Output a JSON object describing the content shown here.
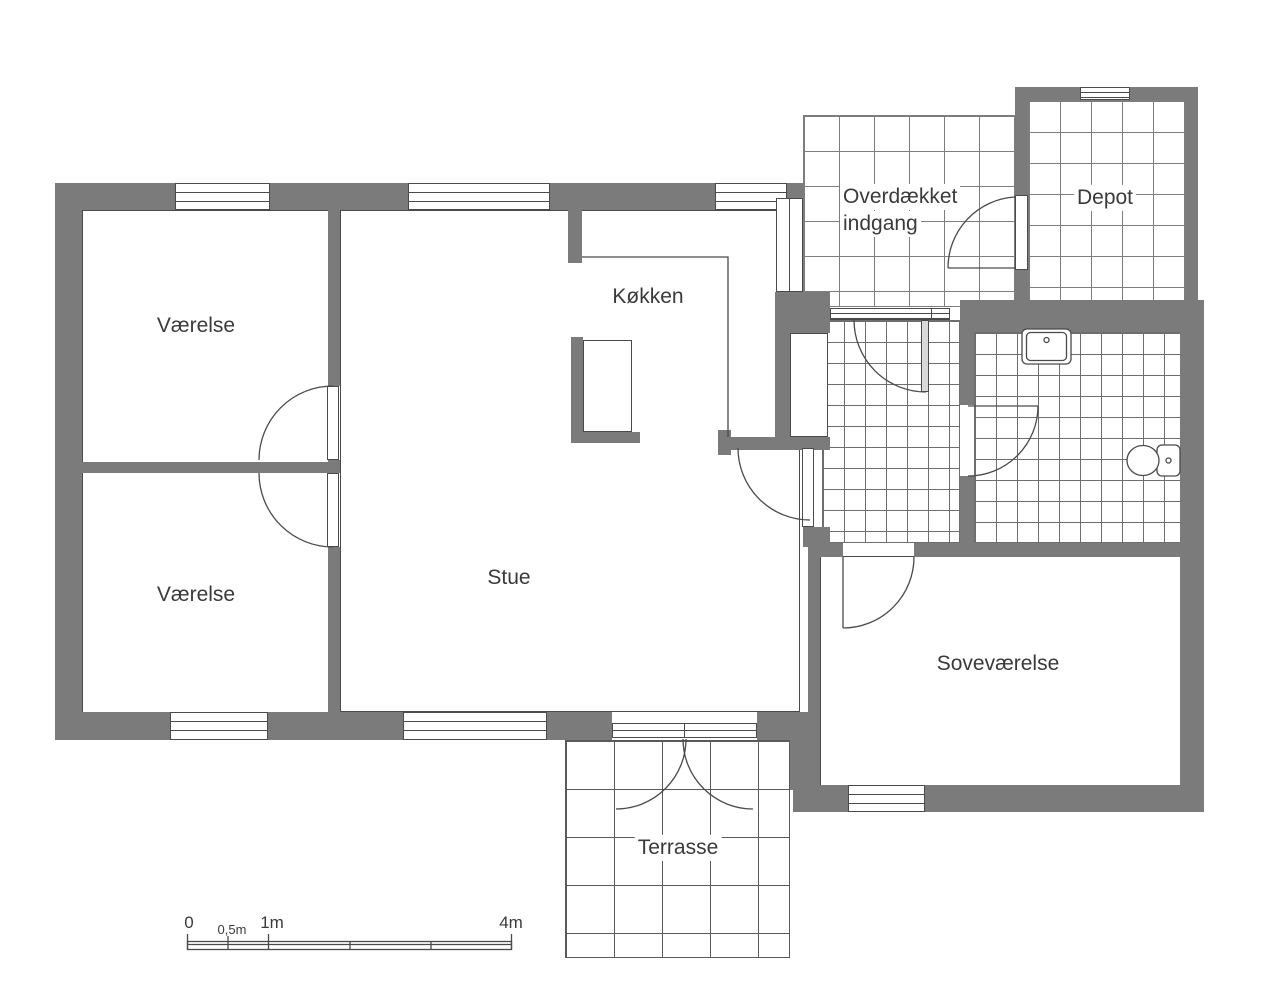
{
  "rooms": {
    "vaerelse1": "Værelse",
    "vaerelse2": "Værelse",
    "koekken": "Køkken",
    "stue": "Stue",
    "sovevaerelse": "Soveværelse",
    "overdaekket_line1": "Overdækket",
    "overdaekket_line2": "indgang",
    "depot": "Depot",
    "terrasse": "Terrasse"
  },
  "scale": {
    "t0": "0",
    "t05": "0,5m",
    "t1": "1m",
    "t4": "4m"
  },
  "colors": {
    "wall": "#7b7b7b",
    "line": "#4a4a4a",
    "text": "#3a3a3a"
  }
}
